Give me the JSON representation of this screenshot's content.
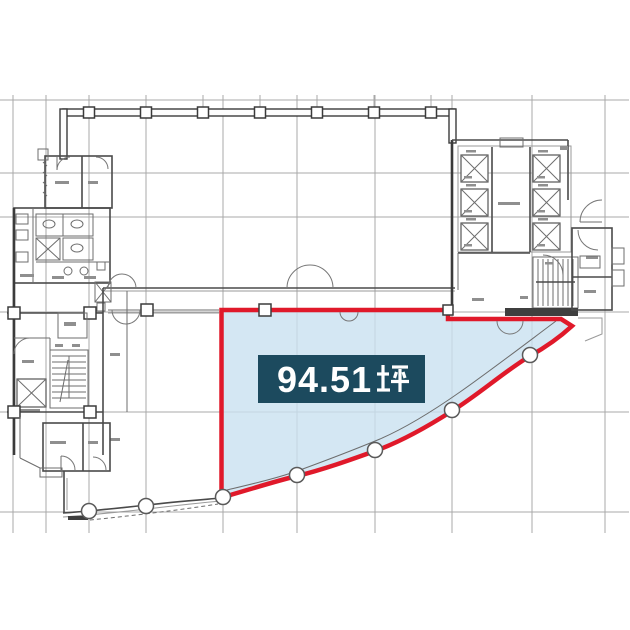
{
  "floorplan": {
    "area_label": "94.51坪",
    "area_value": "94.51",
    "area_unit_glyph": "坪",
    "highlight_fill": "#c9e1f0",
    "highlight_border": "#e0192a",
    "label_box_bg": "#1c4a5e",
    "label_text_color": "#ffffff",
    "grid_color": "#a8a8a8",
    "wall_color": "#3b3b3b"
  }
}
